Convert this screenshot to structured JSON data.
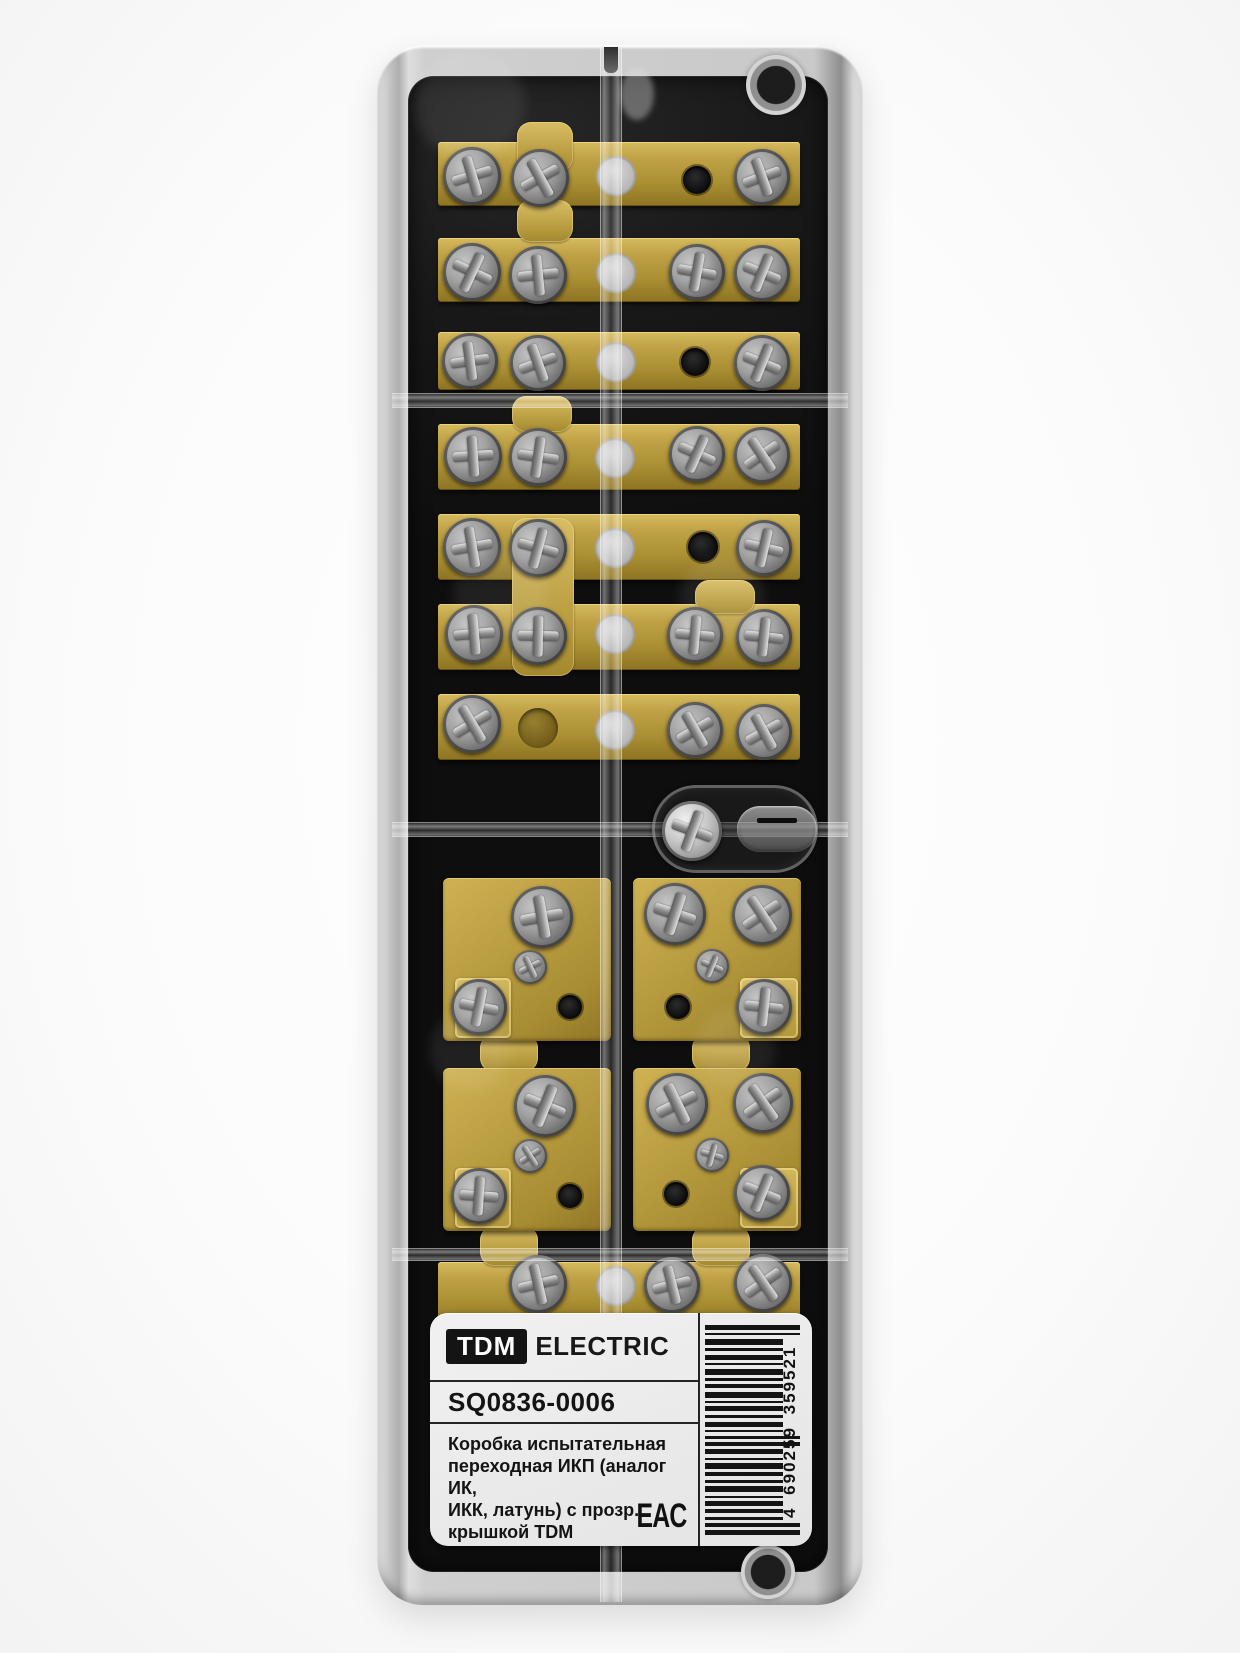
{
  "product": {
    "brand": "TDM",
    "brand_suffix": "ELECTRIC",
    "sku": "SQ0836-0006",
    "description_lines": [
      "Коробка испытательная",
      "переходная ИКП (аналог ИК,",
      "ИКК, латунь) с прозр.",
      "крышкой TDM"
    ],
    "made_in": "Сделано в России",
    "certification_mark": "EAC",
    "barcode": {
      "value": "4690259359521",
      "display": "4 690259 359521"
    }
  },
  "colors": {
    "brass": "#b4973c",
    "interior_black": "#161616",
    "cover_gray": "#c9c9c9",
    "label_background": "#e9e9e9",
    "label_text": "#141414",
    "page_background": "#fdfdfd"
  }
}
